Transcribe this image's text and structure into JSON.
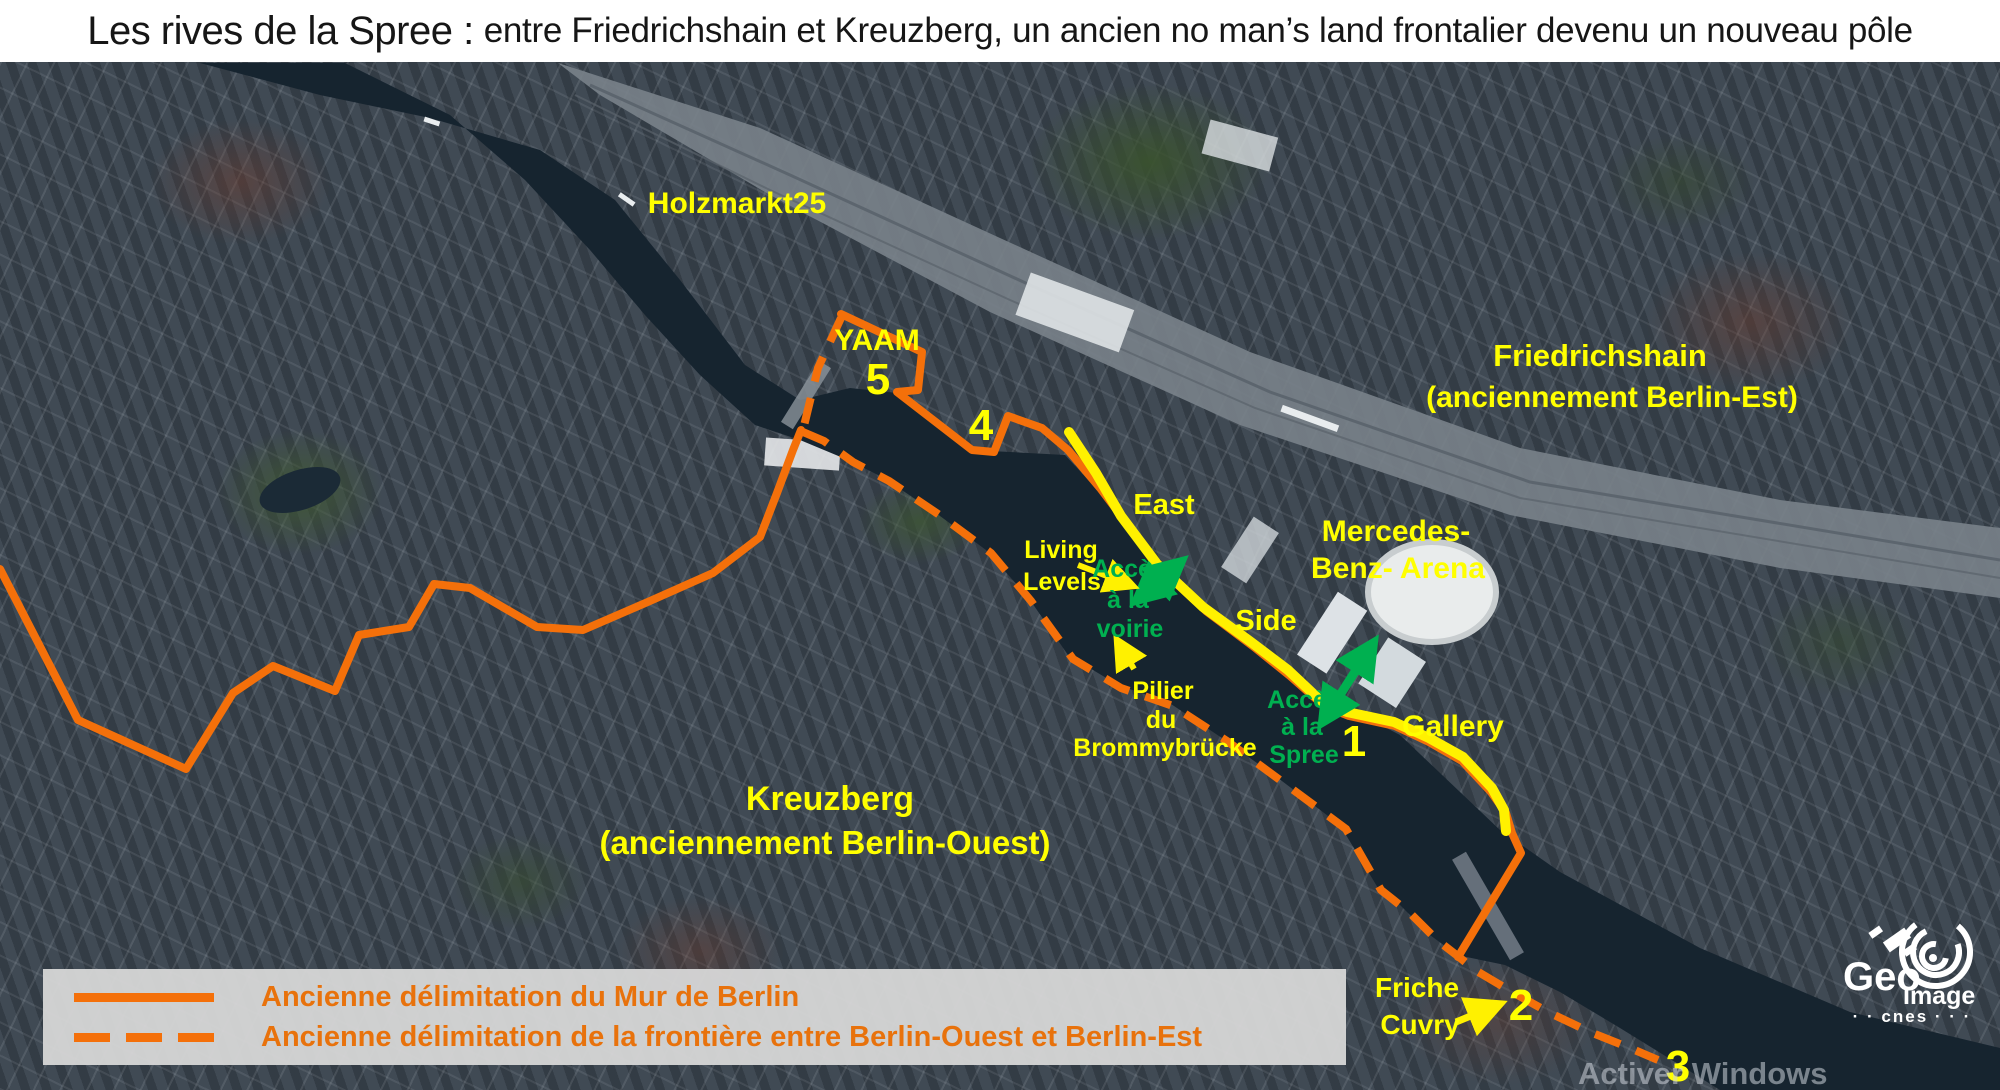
{
  "title": {
    "lead": "Les rives de la Spree :",
    "rest": "entre Friedrichshain et Kreuzberg, un ancien no man’s land frontalier devenu un nouveau pôle"
  },
  "labels": {
    "holzmarkt": "Holzmarkt25",
    "yaam": "YAAM",
    "east": "East",
    "living_1": "Living",
    "living_2": "Levels",
    "acces_voirie_1": "Accès",
    "acces_voirie_2": "à la",
    "acces_voirie_3": "voirie",
    "mercedes_1": "Mercedes-",
    "mercedes_2": "Benz- Arena",
    "side": "Side",
    "pilier_1": "Pilier",
    "pilier_2": "du",
    "pilier_3": "Brommybrücke",
    "acces_spree_1": "Accès",
    "acces_spree_2": "à la",
    "acces_spree_3": "Spree",
    "gallery": "Gallery",
    "friedrichshain_1": "Friedrichshain",
    "friedrichshain_2": "(anciennement Berlin-Est)",
    "kreuzberg_1": "Kreuzberg",
    "kreuzberg_2": "(anciennement Berlin-Ouest)",
    "friche_1": "Friche",
    "friche_2": "Cuvry"
  },
  "markers": {
    "n1": "1",
    "n2": "2",
    "n3": "3",
    "n4": "4",
    "n5": "5"
  },
  "legend": {
    "solid_label": "Ancienne délimitation du Mur de Berlin",
    "dashed_label": "Ancienne délimitation de la frontière entre Berlin-Ouest et Berlin-Est"
  },
  "logo": {
    "geo": "Geo",
    "image": "Image",
    "cnes": "· ·  cnes  · · ·"
  },
  "watermark": "Activer Windows",
  "colors": {
    "line_orange": "#F4700A",
    "legend_text_orange": "#E8720C",
    "label_yellow": "#FFFF00",
    "highlight_yellow": "#FFF100",
    "access_green": "#00B050",
    "river": "#16242F",
    "legend_bg": "#D7D7D7"
  }
}
